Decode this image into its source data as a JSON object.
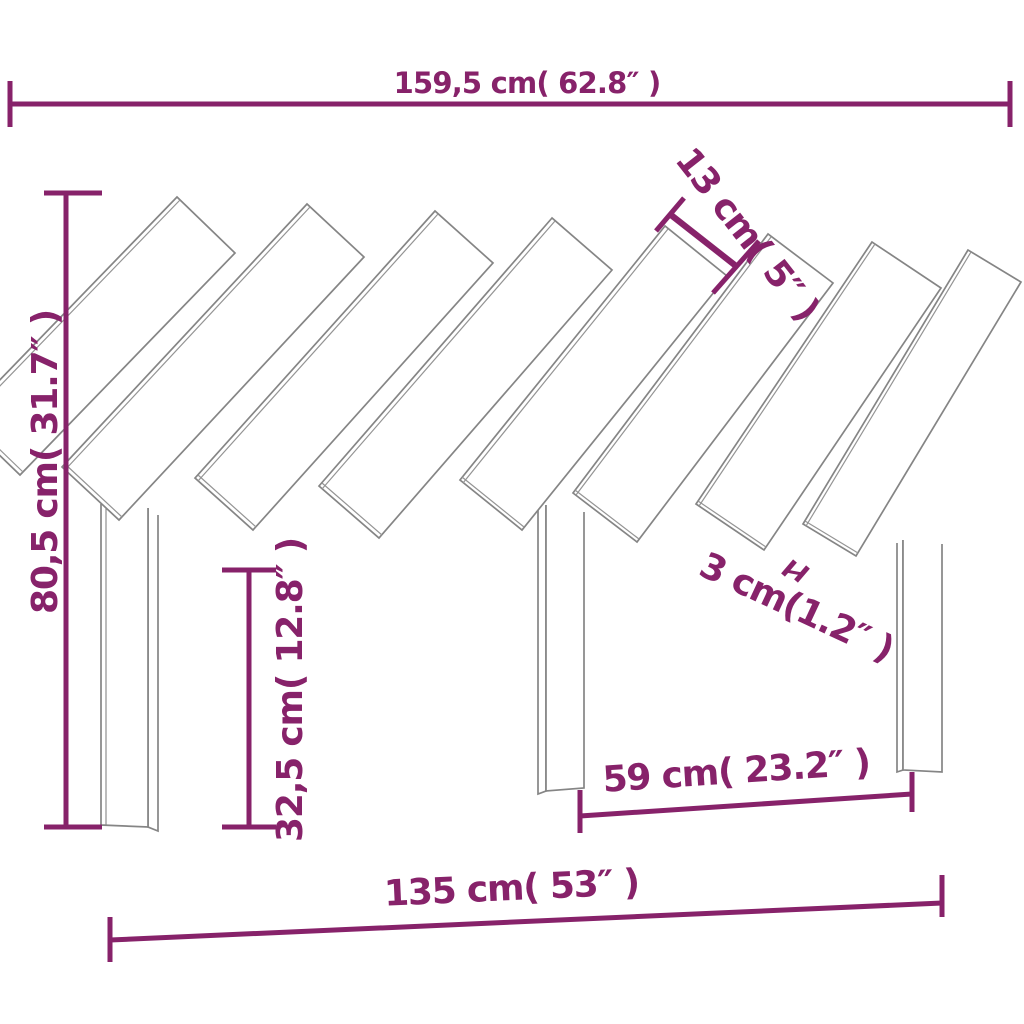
{
  "figure": {
    "kind": "product-dimension-diagram",
    "subject": "slatted-headboard-line-drawing",
    "slat_count": 8,
    "leg_count": 3
  },
  "colors": {
    "dimension": "#87226a",
    "outline": "#858585",
    "outline_light": "#949494",
    "background": "#ffffff"
  },
  "dimensions": {
    "width_top": {
      "cm": "159,5",
      "inch": "62.8",
      "label": "159,5 cm( 62.8″ )"
    },
    "height_left": {
      "cm": "80,5",
      "inch": "31.7",
      "label": "80,5 cm( 31.7″ )"
    },
    "slat_width": {
      "cm": "13",
      "inch": "5",
      "label": "13 cm( 5″ )"
    },
    "slat_gap": {
      "cm": "3",
      "inch": "1.2",
      "label": "3 cm(1.2″ )"
    },
    "leg_height": {
      "cm": "32,5",
      "inch": "12.8",
      "label": "32,5 cm( 12.8″ )"
    },
    "inner_span": {
      "cm": "59",
      "inch": "23.2",
      "label": "59 cm( 23.2″ )"
    },
    "width_bottom": {
      "cm": "135",
      "inch": "53",
      "label": "135 cm( 53″ )"
    }
  }
}
